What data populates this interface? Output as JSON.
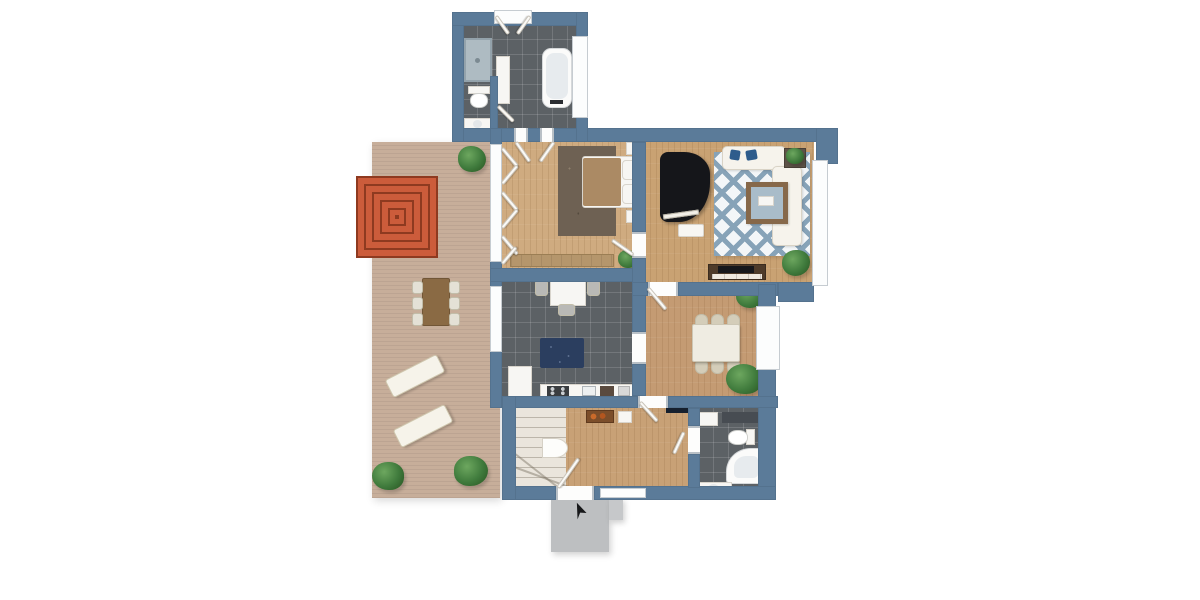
{
  "meta": {
    "kind": "floor-plan-3d-render",
    "view": "top-down",
    "text_visible": "none"
  },
  "colors": {
    "background": "#ffffff",
    "wall": "#5b7b99",
    "wood_floor": "#cba87d",
    "tile_floor": "#5c6165",
    "deck": "#c7ae9a",
    "stoop_concrete": "#bdbfc1",
    "rug_red": "#cc5c3b",
    "rug_red_line": "#8e3a20",
    "rug_navy": "#2b3e5f",
    "rug_taupe": "#6e6153",
    "rug_blue_stripe": "#87a3b8",
    "rug_blue_base": "#f3f6f8",
    "piano_black": "#15161a",
    "sofa_white": "#f6f3ec",
    "pillow_blue": "#2e5c8c",
    "furniture_wood": "#8a6a44",
    "console_dark": "#4e3b2a",
    "plant_green": "#3f7a3c",
    "fixture_white": "#f7f6f3",
    "window_frame": "#c6ccd1",
    "stairs": "#eae5dc"
  },
  "rooms": [
    {
      "id": "terrace",
      "floor": "wood-deck",
      "items": [
        "red-concentric-rug",
        "outdoor-table",
        "six-outdoor-chairs",
        "sun-lounger",
        "sun-lounger",
        "potted-plant",
        "potted-plant",
        "potted-plant"
      ]
    },
    {
      "id": "bathroom-upper",
      "floor": "dark-tile",
      "items": [
        "shower",
        "toilet",
        "washbasin",
        "tall-cabinet",
        "bathtub",
        "window",
        "open-window-leaves"
      ]
    },
    {
      "id": "bedroom",
      "floor": "wood",
      "items": [
        "double-bed",
        "brown-blanket",
        "two-pillows",
        "nightstand",
        "nightstand",
        "speckled-rug",
        "low-bench",
        "potted-plant",
        "casement-windows"
      ]
    },
    {
      "id": "living-room",
      "floor": "wood",
      "items": [
        "grand-piano",
        "piano-bench",
        "blue-diamond-rug",
        "sofa",
        "sofa",
        "wood-coffee-table",
        "side-table",
        "tv-console",
        "potted-plant"
      ]
    },
    {
      "id": "kitchen",
      "floor": "gray-tile",
      "items": [
        "breakfast-table",
        "three-chairs",
        "navy-rug",
        "counter",
        "stove",
        "sink",
        "cabinet"
      ]
    },
    {
      "id": "dining-room",
      "floor": "wood",
      "items": [
        "dining-table",
        "six-chairs",
        "potted-plant",
        "potted-plant",
        "window"
      ]
    },
    {
      "id": "hallway",
      "floor": "wood",
      "items": [
        "winder-staircase",
        "console-table",
        "picture-frame",
        "front-door",
        "doormat"
      ]
    },
    {
      "id": "bathroom-lower",
      "floor": "dark-tile",
      "items": [
        "corner-bathtub",
        "toilet",
        "vanity",
        "shelf",
        "dark-mat"
      ]
    },
    {
      "id": "entrance",
      "floor": "concrete",
      "items": [
        "stoop",
        "step",
        "entry-arrow"
      ]
    }
  ]
}
